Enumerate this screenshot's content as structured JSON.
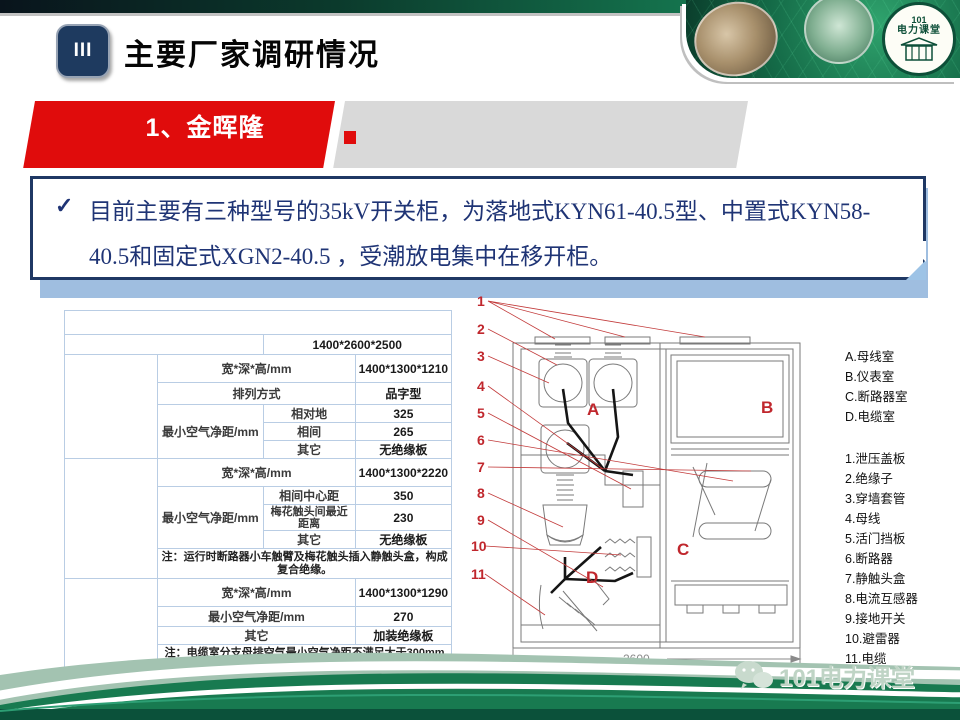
{
  "colors": {
    "accent_red": "#e00c0c",
    "navy": "#1f3864",
    "table_header": "#17375e",
    "table_blue": "#4f81bd",
    "green_dark": "#0d4f38"
  },
  "header": {
    "badge": "III",
    "title": "主要厂家调研情况"
  },
  "banner": {
    "section_title": "1、金晖隆"
  },
  "logo": {
    "circle_line1": "101",
    "circle_line2": "电力课堂",
    "watermark": "101电力课堂"
  },
  "bullet": {
    "check": "✓",
    "line1": "目前主要有三种型号的35kV开关柜，为落地式KYN61-40.5型、中置式KYN58-",
    "line2": "40.5和固定式XGN2-40.5 ，受潮放电集中在移开柜。"
  },
  "table": {
    "title": "KYN58-40.5中置式开关柜 (典型电缆进出线柜型)",
    "overall": {
      "label": "宽*深*高/mm",
      "value": "1400*2600*2500"
    },
    "busbar": {
      "name": "母线室",
      "dims_label": "宽*深*高/mm",
      "dims": "1400*1300*1210",
      "arrange_label": "排列方式",
      "arrange": "品字型",
      "clearance_label": "最小空气净距/mm",
      "rows": [
        {
          "k": "相对地",
          "v": "325"
        },
        {
          "k": "相间",
          "v": "265"
        },
        {
          "k": "其它",
          "v": "无绝缘板"
        }
      ]
    },
    "breaker": {
      "name": "断路器室",
      "dims_label": "宽*深*高/mm",
      "dims": "1400*1300*2220",
      "clearance_label": "最小空气净距/mm",
      "rows": [
        {
          "k": "相间中心距",
          "v": "350"
        },
        {
          "k": "梅花触头间最近距离",
          "v": "230"
        },
        {
          "k": "其它",
          "v": "无绝缘板"
        }
      ],
      "note": "注：运行时断路器小车触臂及梅花触头插入静触头盒，构成复合绝缘。"
    },
    "cable": {
      "name": "电缆室",
      "dims_label": "宽*深*高/mm",
      "dims": "1400*1300*1290",
      "clearance_label": "最小空气净距/mm",
      "clearance": "270",
      "other_label": "其它",
      "other": "加装绝缘板",
      "note": "注：电缆室分支母排空气最小空气净距不满足大于300mm的要求，加装了绝缘挡板。"
    }
  },
  "diagram": {
    "numbers": [
      "1",
      "2",
      "3",
      "4",
      "5",
      "6",
      "7",
      "8",
      "9",
      "10",
      "11"
    ],
    "letters": [
      "A",
      "B",
      "C",
      "D"
    ],
    "dimension": "2600",
    "legend_rooms": [
      "A.母线室",
      "B.仪表室",
      "C.断路器室",
      "D.电缆室"
    ],
    "legend_parts": [
      "1.泄压盖板",
      "2.绝缘子",
      "3.穿墙套管",
      "4.母线",
      "5.活门挡板",
      "6.断路器",
      "7.静触头盒",
      "8.电流互感器",
      "9.接地开关",
      "10.避雷器",
      "11.电缆"
    ]
  }
}
